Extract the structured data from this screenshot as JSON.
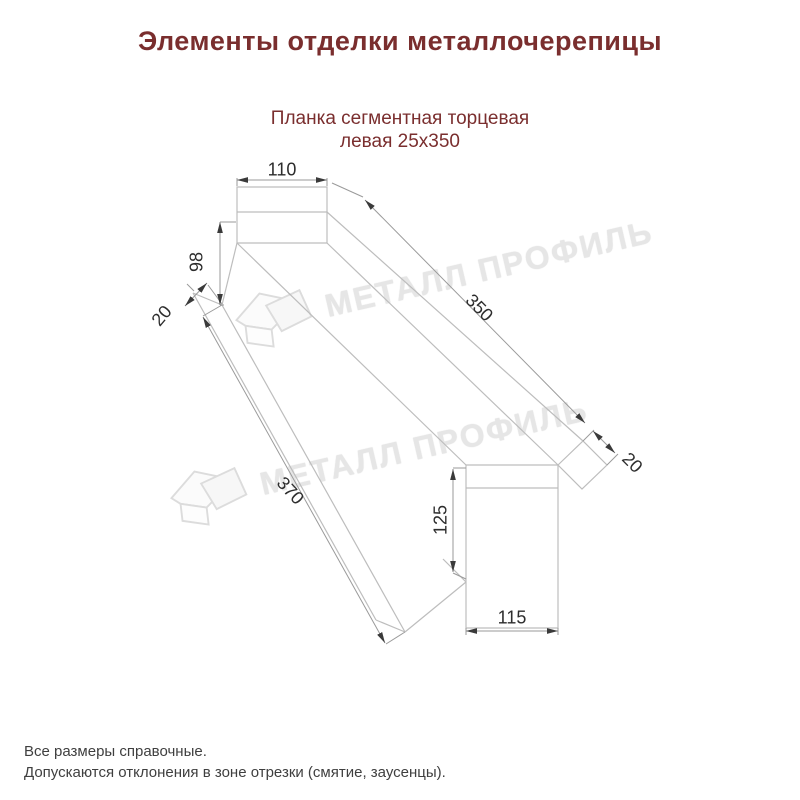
{
  "page": {
    "background": "#ffffff"
  },
  "title": {
    "text": "Элементы отделки металлочерепицы",
    "color": "#7a2e2e"
  },
  "subtitle": {
    "line1": "Планка сегментная торцевая",
    "line2": "левая 25х350",
    "color": "#7a2e2e"
  },
  "drawing": {
    "type": "technical-line-drawing",
    "part": "Планка сегментная торцевая левая 25х350",
    "dimensions": {
      "top_width": "110",
      "left_height": "98",
      "left_lip": "20",
      "top_length": "350",
      "right_lip": "20",
      "bottom_length": "370",
      "right_height": "125",
      "bottom_width": "115"
    },
    "line_color": "#bdbdbd",
    "dim_line_color": "#9a9a9a",
    "arrow_color": "#3a3a3a",
    "label_color": "#2d2d2d"
  },
  "watermark": {
    "text": "МЕТАЛЛ ПРОФИЛЬ",
    "logo": "metal-profil-logo",
    "color": "#e6e6e6"
  },
  "footer": {
    "line1": "Все размеры справочные.",
    "line2": "Допускаются отклонения в зоне отрезки (смятие, заусенцы)."
  }
}
